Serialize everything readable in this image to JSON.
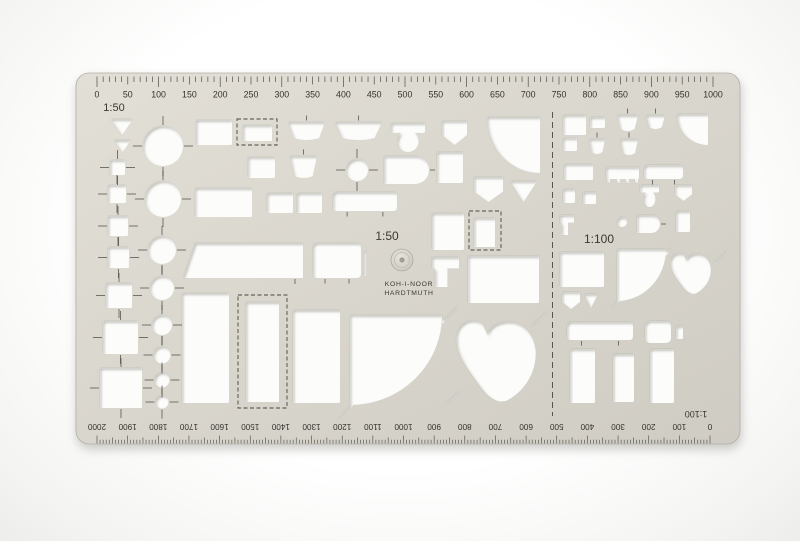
{
  "product": {
    "brand_line1": "KOH-I-NOOR",
    "brand_line2": "HARDTMUTH",
    "description": "furniture drafting template stencil"
  },
  "labels": {
    "scale_top_left": "1:50",
    "scale_center": "1:50",
    "scale_right": "1:100",
    "scale_bottom_flipped": "1:100"
  },
  "colors": {
    "body_light": "#e1ded6",
    "body_dark": "#d1cec5",
    "body_stroke": "#b3b0a6",
    "cutout": "#fcfcfa",
    "engrave": "#46443e",
    "number": "#34332e",
    "shadow": "#93918a"
  },
  "rulers": {
    "top": {
      "scale": "1:50",
      "min": 0,
      "max": 1000,
      "label_step": 50,
      "labels": [
        "0",
        "50",
        "100",
        "150",
        "200",
        "250",
        "300",
        "350",
        "400",
        "450",
        "500",
        "550",
        "600",
        "650",
        "700",
        "750",
        "800",
        "850",
        "900",
        "950",
        "1000"
      ]
    },
    "bottom": {
      "scale": "1:100",
      "min": 0,
      "max": 2000,
      "label_step": 100,
      "flipped": true,
      "labels": [
        "0",
        "100",
        "200",
        "300",
        "400",
        "500",
        "600",
        "700",
        "800",
        "900",
        "1000",
        "1100",
        "1200",
        "1300",
        "1400",
        "1500",
        "1600",
        "1700",
        "1800",
        "1900",
        "2000"
      ]
    }
  },
  "shapes": [
    {
      "n": "triangle-marker-large",
      "t": "tri",
      "x": 111,
      "y": 119,
      "w": 22,
      "h": 16
    },
    {
      "n": "triangle-marker-small",
      "t": "tri",
      "x": 114,
      "y": 140,
      "w": 17,
      "h": 12
    },
    {
      "n": "square-marker-1",
      "t": "sqc",
      "x": 110,
      "y": 160,
      "w": 15,
      "h": 15
    },
    {
      "n": "square-marker-2",
      "t": "sqc",
      "x": 108,
      "y": 185,
      "w": 18,
      "h": 18
    },
    {
      "n": "square-marker-3",
      "t": "sqc",
      "x": 108,
      "y": 216,
      "w": 20,
      "h": 20
    },
    {
      "n": "square-marker-4",
      "t": "sqc",
      "x": 108,
      "y": 247,
      "w": 21,
      "h": 21
    },
    {
      "n": "square-marker-5",
      "t": "sqc",
      "x": 106,
      "y": 283,
      "w": 26,
      "h": 25
    },
    {
      "n": "square-marker-6",
      "t": "sqc",
      "x": 103,
      "y": 321,
      "w": 35,
      "h": 33
    },
    {
      "n": "square-marker-7",
      "t": "sqc",
      "x": 100,
      "y": 368,
      "w": 42,
      "h": 40
    },
    {
      "n": "circle-1",
      "t": "circle",
      "cx": 163,
      "cy": 146,
      "r": 20,
      "cross": true
    },
    {
      "n": "circle-2",
      "t": "circle",
      "cx": 163,
      "cy": 199,
      "r": 18,
      "cross": true
    },
    {
      "n": "circle-3",
      "t": "circle",
      "cx": 162,
      "cy": 250,
      "r": 14,
      "cross": true
    },
    {
      "n": "circle-4",
      "t": "circle",
      "cx": 162,
      "cy": 288,
      "r": 12,
      "cross": true
    },
    {
      "n": "circle-5",
      "t": "circle",
      "cx": 162,
      "cy": 325,
      "r": 10,
      "cross": true
    },
    {
      "n": "circle-6",
      "t": "circle",
      "cx": 162,
      "cy": 355,
      "r": 8.5,
      "cross": true
    },
    {
      "n": "circle-7",
      "t": "circle",
      "cx": 162,
      "cy": 380,
      "r": 7.5,
      "cross": true
    },
    {
      "n": "circle-8",
      "t": "circle",
      "cx": 162,
      "cy": 402,
      "r": 6.5,
      "cross": true
    },
    {
      "n": "wardrobe",
      "t": "rect",
      "x": 196,
      "y": 120,
      "w": 36,
      "h": 25
    },
    {
      "n": "dashed-box",
      "t": "dashrect",
      "x": 237,
      "y": 119,
      "w": 40,
      "h": 26,
      "ix": 243,
      "iy": 125,
      "iw": 29,
      "ih": 16
    },
    {
      "n": "washbasin-small",
      "t": "sink",
      "x": 288,
      "y": 122,
      "w": 37,
      "h": 16
    },
    {
      "n": "washbasin-large",
      "t": "sink",
      "x": 335,
      "y": 122,
      "w": 47,
      "h": 16
    },
    {
      "n": "toilet",
      "t": "toilet",
      "x": 391,
      "y": 123,
      "w": 34,
      "h": 29
    },
    {
      "n": "shower",
      "t": "pent",
      "x": 442,
      "y": 121,
      "w": 25,
      "h": 24
    },
    {
      "n": "corner-bath",
      "t": "quarter",
      "corner": "tr",
      "x": 487,
      "y": 117,
      "w": 53,
      "h": 56
    },
    {
      "n": "cabinet",
      "t": "rect",
      "x": 248,
      "y": 157,
      "w": 27,
      "h": 21
    },
    {
      "n": "washbasin-3",
      "t": "sink",
      "x": 290,
      "y": 156,
      "w": 27,
      "h": 20
    },
    {
      "n": "side-table-round",
      "t": "circle",
      "cx": 357,
      "cy": 170,
      "r": 11,
      "cross": true
    },
    {
      "n": "bathtub-round-end",
      "t": "drect",
      "x": 384,
      "y": 156,
      "w": 45,
      "h": 28
    },
    {
      "n": "tall-cabinet",
      "t": "rect",
      "x": 437,
      "y": 152,
      "w": 26,
      "h": 31
    },
    {
      "n": "shower-2",
      "t": "pent",
      "x": 474,
      "y": 177,
      "w": 29,
      "h": 25
    },
    {
      "n": "bidet-triangle",
      "t": "tri",
      "x": 510,
      "y": 181,
      "w": 27,
      "h": 21
    },
    {
      "n": "desk",
      "t": "rect",
      "x": 195,
      "y": 188,
      "w": 57,
      "h": 29
    },
    {
      "n": "night-table-1",
      "t": "rect",
      "x": 267,
      "y": 193,
      "w": 26,
      "h": 20
    },
    {
      "n": "night-table-2",
      "t": "rect",
      "x": 297,
      "y": 193,
      "w": 25,
      "h": 20
    },
    {
      "n": "bathtub",
      "t": "tub",
      "x": 333,
      "y": 192,
      "w": 64,
      "h": 19
    },
    {
      "n": "fridge",
      "t": "rect",
      "x": 432,
      "y": 213,
      "w": 32,
      "h": 37
    },
    {
      "n": "dashed-square",
      "t": "dashrect",
      "x": 469,
      "y": 211,
      "w": 32,
      "h": 39,
      "ix": 474,
      "iy": 218,
      "iw": 21,
      "ih": 29
    },
    {
      "n": "sink-unit",
      "t": "tshape",
      "x": 432,
      "y": 257,
      "w": 27,
      "h": 30
    },
    {
      "n": "table-large",
      "t": "rect",
      "x": 468,
      "y": 256,
      "w": 71,
      "h": 47
    },
    {
      "n": "sofa",
      "t": "trap",
      "x": 183,
      "y": 243,
      "w": 120,
      "h": 35
    },
    {
      "n": "bathtub-2",
      "t": "tub2",
      "x": 313,
      "y": 243,
      "w": 48,
      "h": 35
    },
    {
      "n": "bed-single",
      "t": "rect",
      "x": 182,
      "y": 293,
      "w": 47,
      "h": 110
    },
    {
      "n": "bed-dashed",
      "t": "dashrect",
      "x": 238,
      "y": 295,
      "w": 49,
      "h": 113,
      "ix": 246,
      "iy": 302,
      "iw": 33,
      "ih": 100
    },
    {
      "n": "bed-single-2",
      "t": "rect",
      "x": 293,
      "y": 310,
      "w": 47,
      "h": 93
    },
    {
      "n": "piano-quarter",
      "t": "quarter",
      "corner": "tl",
      "x": 350,
      "y": 315,
      "w": 92,
      "h": 90
    },
    {
      "n": "grand-piano",
      "t": "piano",
      "x": 452,
      "y": 316,
      "w": 86,
      "h": 88
    },
    {
      "n": "door-slit-1",
      "t": "slit",
      "x1": 443,
      "y1": 322,
      "x2": 457,
      "y2": 308
    },
    {
      "n": "door-slit-2",
      "t": "slit",
      "x1": 533,
      "y1": 326,
      "x2": 547,
      "y2": 312
    },
    {
      "n": "door-slit-3",
      "t": "slit",
      "x1": 340,
      "y1": 419,
      "x2": 352,
      "y2": 405
    },
    {
      "n": "door-slit-4",
      "t": "slit",
      "x1": 447,
      "y1": 404,
      "x2": 459,
      "y2": 392
    },
    {
      "n": "h-wardrobe",
      "t": "rect",
      "x": 563,
      "y": 115,
      "w": 23,
      "h": 20
    },
    {
      "n": "h-cabinet",
      "t": "rect",
      "x": 590,
      "y": 117,
      "w": 15,
      "h": 11
    },
    {
      "n": "h-washbasin-1",
      "t": "sink",
      "x": 617,
      "y": 115,
      "w": 21,
      "h": 14
    },
    {
      "n": "h-washbasin-2",
      "t": "sink",
      "x": 646,
      "y": 115,
      "w": 19,
      "h": 12
    },
    {
      "n": "h-corner-bath",
      "t": "quarter",
      "corner": "tr",
      "x": 677,
      "y": 114,
      "w": 31,
      "h": 31
    },
    {
      "n": "h-cabinet-2",
      "t": "rect",
      "x": 563,
      "y": 138,
      "w": 14,
      "h": 13
    },
    {
      "n": "h-washbasin-3",
      "t": "sink",
      "x": 589,
      "y": 139,
      "w": 16,
      "h": 13
    },
    {
      "n": "h-washbasin-4",
      "t": "sink",
      "x": 620,
      "y": 139,
      "w": 18,
      "h": 14
    },
    {
      "n": "h-desk",
      "t": "rect",
      "x": 564,
      "y": 164,
      "w": 29,
      "h": 16
    },
    {
      "n": "h-table",
      "t": "table",
      "x": 606,
      "y": 167,
      "w": 33,
      "h": 15
    },
    {
      "n": "h-bathtub",
      "t": "tub",
      "x": 644,
      "y": 165,
      "w": 39,
      "h": 14
    },
    {
      "n": "h-cab-3",
      "t": "rect",
      "x": 563,
      "y": 189,
      "w": 12,
      "h": 14
    },
    {
      "n": "h-cab-4",
      "t": "rect",
      "x": 583,
      "y": 192,
      "w": 13,
      "h": 12
    },
    {
      "n": "h-toilet",
      "t": "toilet",
      "x": 640,
      "y": 185,
      "w": 19,
      "h": 22
    },
    {
      "n": "h-shower",
      "t": "pent",
      "x": 675,
      "y": 185,
      "w": 17,
      "h": 16
    },
    {
      "n": "h-sink-unit",
      "t": "tshape",
      "x": 560,
      "y": 215,
      "w": 14,
      "h": 20
    },
    {
      "n": "h-stool",
      "t": "circle",
      "cx": 622,
      "cy": 222,
      "r": 5,
      "cross": false
    },
    {
      "n": "h-tub-round",
      "t": "drect",
      "x": 637,
      "y": 215,
      "w": 23,
      "h": 18
    },
    {
      "n": "h-door",
      "t": "rect",
      "x": 676,
      "y": 211,
      "w": 14,
      "h": 21
    },
    {
      "n": "h-bed-double",
      "t": "rect",
      "x": 560,
      "y": 252,
      "w": 44,
      "h": 35
    },
    {
      "n": "h-piano-quarter",
      "t": "quarter",
      "corner": "tl",
      "x": 617,
      "y": 249,
      "w": 49,
      "h": 52
    },
    {
      "n": "h-grand-piano",
      "t": "piano",
      "x": 668,
      "y": 251,
      "w": 44,
      "h": 44
    },
    {
      "n": "h-shower-2",
      "t": "pent",
      "x": 562,
      "y": 292,
      "w": 18,
      "h": 17
    },
    {
      "n": "h-bidet-tri",
      "t": "tri",
      "x": 584,
      "y": 294,
      "w": 14,
      "h": 14
    },
    {
      "n": "h-sofa",
      "t": "tub",
      "x": 567,
      "y": 322,
      "w": 66,
      "h": 18
    },
    {
      "n": "h-armchair",
      "t": "chair",
      "x": 645,
      "y": 321,
      "w": 26,
      "h": 22
    },
    {
      "n": "h-chair-tab",
      "t": "rect",
      "x": 676,
      "y": 326,
      "w": 7,
      "h": 13
    },
    {
      "n": "h-bed-1",
      "t": "rect",
      "x": 570,
      "y": 349,
      "w": 25,
      "h": 54
    },
    {
      "n": "h-bed-2",
      "t": "rect",
      "x": 613,
      "y": 354,
      "w": 21,
      "h": 48
    },
    {
      "n": "h-bed-3",
      "t": "rect",
      "x": 650,
      "y": 349,
      "w": 24,
      "h": 54
    },
    {
      "n": "h-door-slit-1",
      "t": "slit",
      "x1": 663,
      "y1": 257,
      "x2": 672,
      "y2": 248
    },
    {
      "n": "h-door-slit-2",
      "t": "slit",
      "x1": 716,
      "y1": 263,
      "x2": 727,
      "y2": 252
    },
    {
      "n": "h-door-slit-3",
      "t": "slit",
      "x1": 613,
      "y1": 307,
      "x2": 623,
      "y2": 296
    }
  ]
}
